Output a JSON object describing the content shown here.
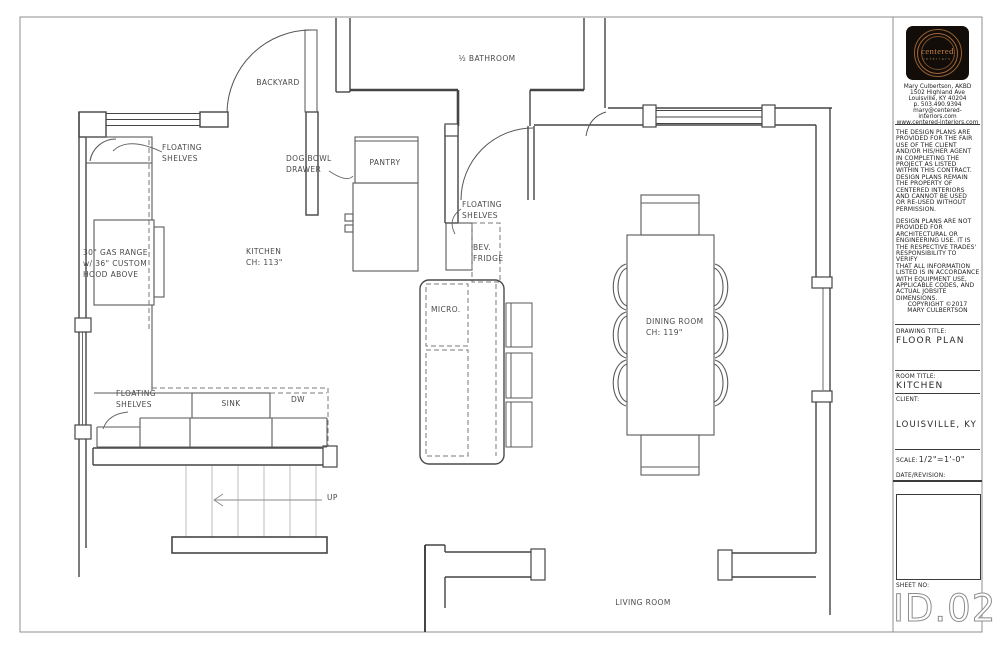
{
  "floor_plan": {
    "labels": {
      "backyard": "BACKYARD",
      "bathroom": "½ BATHROOM",
      "pantry": "PANTRY",
      "dog_bowl": "DOG BOWL\nDRAWER",
      "floating_shelves_top": "FLOATING\nSHELVES",
      "floating_shelves_mid": "FLOATING\nSHELVES",
      "floating_shelves_bottom": "FLOATING\nSHELVES",
      "gas_range": "30\" GAS RANGE\nw/ 36\" CUSTOM\nHOOD ABOVE",
      "kitchen": "KITCHEN\nCH: 113\"",
      "bev_fridge": "BEV.\nFRIDGE",
      "micro": "MICRO.",
      "sink": "SINK",
      "dw": "DW",
      "dining_room": "DINING ROOM\nCH: 119\"",
      "up": "UP",
      "living_room": "LIVING ROOM"
    }
  },
  "title_block": {
    "logo": {
      "brand": "centered",
      "sub": "interiors"
    },
    "contact": "Mary Culbertson, AKBD\n1502 Highland Ave\nLouisville, KY 40204\np. 503.490.9394\nmary@centered-interiors.com\nwww.centered-interiors.com",
    "disclaimer_1": "THE DESIGN PLANS ARE\nPROVIDED FOR THE FAIR\nUSE OF THE CLIENT\nAND/OR HIS/HER AGENT\nIN COMPLETING THE\nPROJECT AS LISTED\nWITHIN THIS CONTRACT.\nDESIGN PLANS REMAIN\nTHE PROPERTY OF\nCENTERED INTERIORS\nAND CANNOT BE USED\nOR RE-USED WITHOUT\nPERMISSION.",
    "disclaimer_2": "DESIGN PLANS ARE NOT\nPROVIDED FOR\nARCHITECTURAL OR\nENGINEERING USE. IT IS\nTHE RESPECTIVE TRADES'\nRESPONSIBILITY TO VERIFY\nTHAT ALL INFORMATION\nLISTED IS IN ACCORDANCE\nWITH EQUIPMENT USE,\nAPPLICABLE CODES, AND\nACTUAL JOBSITE\nDIMENSIONS.",
    "copyright": "COPYRIGHT ©2017\nMARY CULBERTSON",
    "drawing_title_label": "DRAWING TITLE:",
    "drawing_title": "FLOOR PLAN",
    "room_title_label": "ROOM TITLE:",
    "room_title": "KITCHEN",
    "client_label": "CLIENT:",
    "client": "LOUISVILLE, KY",
    "scale_label": "SCALE:",
    "scale_value": "1/2\"=1'-0\"",
    "date_label": "DATE/REVISION:",
    "sheet_label": "SHEET NO:",
    "sheet_no": "ID.02"
  },
  "colors": {
    "wall_line": "#454545",
    "accent_copper": "#a5683b",
    "page_border": "#8f8f8f"
  }
}
